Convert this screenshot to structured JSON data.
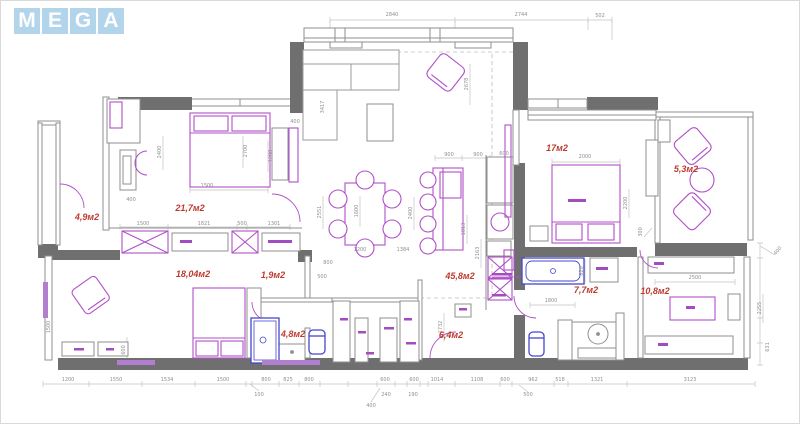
{
  "logo": {
    "letters": [
      "M",
      "E",
      "G",
      "A"
    ]
  },
  "colors": {
    "wall": "#6f6f6f",
    "furniture": "#b050c8",
    "sanitary": "#4646cf",
    "room_label": "#bf3a2e",
    "dimension_text": "#8f8f8f",
    "logo_bg": "#b2d5ec",
    "logo_text": "#ffffff"
  },
  "plan": {
    "room_labels": [
      {
        "text": "4,9м2",
        "x": 87,
        "y": 217
      },
      {
        "text": "21,7м2",
        "x": 190,
        "y": 208
      },
      {
        "text": "18,04м2",
        "x": 193,
        "y": 274
      },
      {
        "text": "1,9м2",
        "x": 273,
        "y": 275
      },
      {
        "text": "4,8м2",
        "x": 293,
        "y": 334
      },
      {
        "text": "45,8м2",
        "x": 460,
        "y": 276
      },
      {
        "text": "6,4м2",
        "x": 451,
        "y": 335
      },
      {
        "text": "17м2",
        "x": 557,
        "y": 148
      },
      {
        "text": "5,3м2",
        "x": 686,
        "y": 169
      },
      {
        "text": "7,7м2",
        "x": 586,
        "y": 290
      },
      {
        "text": "10,8м2",
        "x": 655,
        "y": 291
      }
    ],
    "dimensions": [
      {
        "text": "2840",
        "x": 392,
        "y": 15
      },
      {
        "text": "2744",
        "x": 521,
        "y": 15
      },
      {
        "text": "502",
        "x": 600,
        "y": 16
      },
      {
        "text": "400",
        "x": 295,
        "y": 122
      },
      {
        "text": "400",
        "x": 131,
        "y": 200
      },
      {
        "text": "2400",
        "x": 160,
        "y": 152,
        "rot": -90
      },
      {
        "text": "2700",
        "x": 246,
        "y": 151,
        "rot": -90
      },
      {
        "text": "1500",
        "x": 207,
        "y": 186
      },
      {
        "text": "1200",
        "x": 271,
        "y": 156,
        "rot": -90
      },
      {
        "text": "1500",
        "x": 143,
        "y": 224
      },
      {
        "text": "1821",
        "x": 204,
        "y": 224
      },
      {
        "text": "500",
        "x": 242,
        "y": 224
      },
      {
        "text": "1301",
        "x": 274,
        "y": 224
      },
      {
        "text": "3417",
        "x": 323,
        "y": 107,
        "rot": -90
      },
      {
        "text": "2678",
        "x": 467,
        "y": 84,
        "rot": -90
      },
      {
        "text": "900",
        "x": 449,
        "y": 155
      },
      {
        "text": "900",
        "x": 478,
        "y": 155
      },
      {
        "text": "2551",
        "x": 320,
        "y": 212,
        "rot": -90
      },
      {
        "text": "1600",
        "x": 357,
        "y": 211,
        "rot": -90
      },
      {
        "text": "2400",
        "x": 411,
        "y": 213,
        "rot": -90
      },
      {
        "text": "1813",
        "x": 464,
        "y": 229,
        "rot": -90
      },
      {
        "text": "1200",
        "x": 360,
        "y": 250
      },
      {
        "text": "1384",
        "x": 403,
        "y": 250
      },
      {
        "text": "800",
        "x": 328,
        "y": 263
      },
      {
        "text": "500",
        "x": 322,
        "y": 277
      },
      {
        "text": "600",
        "x": 504,
        "y": 154
      },
      {
        "text": "2163",
        "x": 478,
        "y": 253,
        "rot": -90
      },
      {
        "text": "2000",
        "x": 585,
        "y": 157
      },
      {
        "text": "2200",
        "x": 626,
        "y": 203,
        "rot": -90
      },
      {
        "text": "300",
        "x": 641,
        "y": 232,
        "rot": -90
      },
      {
        "text": "1800",
        "x": 551,
        "y": 301
      },
      {
        "text": "1732",
        "x": 441,
        "y": 327,
        "rot": -90
      },
      {
        "text": "820",
        "x": 582,
        "y": 271,
        "rot": -90
      },
      {
        "text": "2500",
        "x": 695,
        "y": 278
      },
      {
        "text": "2255",
        "x": 760,
        "y": 308,
        "rot": -90
      },
      {
        "text": "400",
        "x": 778,
        "y": 251,
        "rot": -50
      },
      {
        "text": "631",
        "x": 768,
        "y": 347,
        "rot": -90
      },
      {
        "text": "1500",
        "x": 49,
        "y": 327,
        "rot": -90
      },
      {
        "text": "600",
        "x": 124,
        "y": 350,
        "rot": -90
      },
      {
        "text": "1200",
        "x": 68,
        "y": 380
      },
      {
        "text": "1550",
        "x": 116,
        "y": 380
      },
      {
        "text": "1534",
        "x": 167,
        "y": 380
      },
      {
        "text": "1500",
        "x": 223,
        "y": 380
      },
      {
        "text": "100",
        "x": 259,
        "y": 395
      },
      {
        "text": "800",
        "x": 266,
        "y": 380
      },
      {
        "text": "825",
        "x": 288,
        "y": 380
      },
      {
        "text": "800",
        "x": 309,
        "y": 380
      },
      {
        "text": "600",
        "x": 385,
        "y": 380
      },
      {
        "text": "240",
        "x": 386,
        "y": 395
      },
      {
        "text": "400",
        "x": 371,
        "y": 406
      },
      {
        "text": "600",
        "x": 414,
        "y": 380
      },
      {
        "text": "190",
        "x": 413,
        "y": 395
      },
      {
        "text": "1014",
        "x": 437,
        "y": 380
      },
      {
        "text": "1108",
        "x": 477,
        "y": 380
      },
      {
        "text": "600",
        "x": 505,
        "y": 380
      },
      {
        "text": "500",
        "x": 528,
        "y": 395
      },
      {
        "text": "962",
        "x": 533,
        "y": 380
      },
      {
        "text": "518",
        "x": 560,
        "y": 380
      },
      {
        "text": "1321",
        "x": 597,
        "y": 380
      },
      {
        "text": "3123",
        "x": 690,
        "y": 380
      }
    ]
  }
}
